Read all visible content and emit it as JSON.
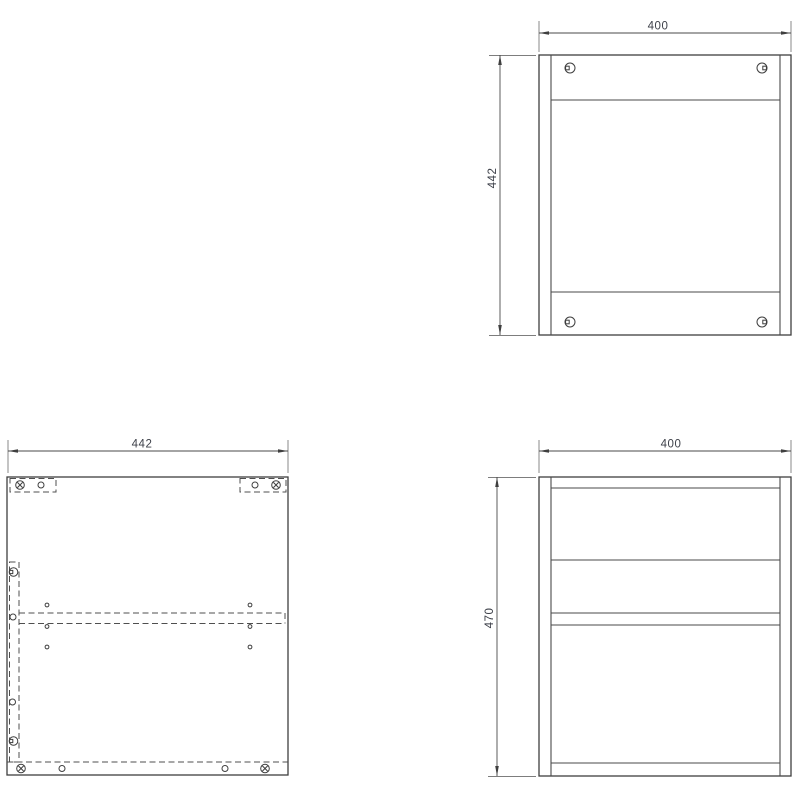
{
  "page": {
    "background": "#ffffff"
  },
  "colors": {
    "object_line": "#3f3f3f",
    "hidden_line": "#4f4f4f",
    "dimension_line": "#4a4a4a",
    "extension_line": "#7d7d7d",
    "dimension_text": "#3d4049"
  },
  "views": {
    "panel_top_right": {
      "width_dim": "400",
      "height_dim": "442"
    },
    "panel_bottom_left": {
      "width_dim": "442"
    },
    "panel_bottom_right": {
      "width_dim": "400",
      "height_dim": "470"
    }
  },
  "icons": {
    "cam_screw": "cam-screw-icon",
    "cross_screw": "cross-screw-icon",
    "dowel_hole": "dowel-hole-icon",
    "pilot_hole": "pilot-hole-icon"
  }
}
